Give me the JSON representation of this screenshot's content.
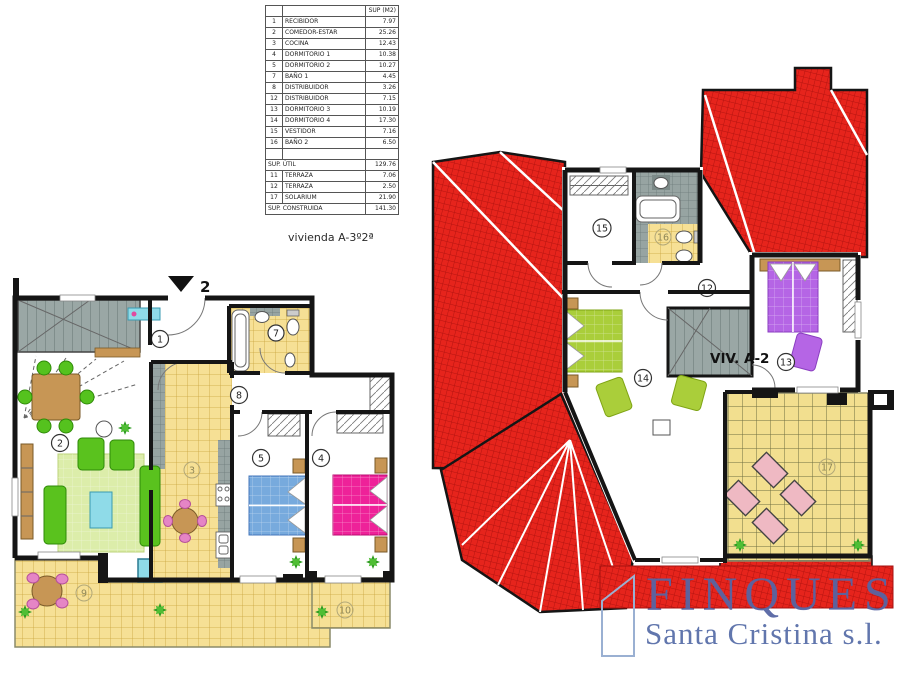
{
  "plan_caption": "vivienda A-3º2ª",
  "unit_label": "VIV. A-2",
  "entrance_number": "2",
  "area_table": {
    "value_header": "SUP (M2)",
    "rows": [
      {
        "num": "1",
        "name": "RECIBIDOR",
        "value": "7.97"
      },
      {
        "num": "2",
        "name": "COMEDOR-ESTAR",
        "value": "25.26"
      },
      {
        "num": "3",
        "name": "COCINA",
        "value": "12.43"
      },
      {
        "num": "4",
        "name": "DORMITORIO 1",
        "value": "10.38"
      },
      {
        "num": "5",
        "name": "DORMITORIO 2",
        "value": "10.27"
      },
      {
        "num": "7",
        "name": "BAÑO 1",
        "value": "4.45"
      },
      {
        "num": "8",
        "name": "DISTRIBUIDOR",
        "value": "3.26"
      },
      {
        "num": "12",
        "name": "DISTRIBUIDOR",
        "value": "7.15"
      },
      {
        "num": "13",
        "name": "DORMITORIO 3",
        "value": "10.19"
      },
      {
        "num": "14",
        "name": "DORMITORIO 4",
        "value": "17.30"
      },
      {
        "num": "15",
        "name": "VESTIDOR",
        "value": "7.16"
      },
      {
        "num": "16",
        "name": "BAÑO 2",
        "value": "6.50"
      },
      {
        "type": "blank"
      },
      {
        "type": "total",
        "name": "SUP. ÚTIL",
        "value": "129.76"
      },
      {
        "num": "11",
        "name": "TERRAZA",
        "value": "7.06"
      },
      {
        "num": "12",
        "name": "TERRAZA",
        "value": "2.50"
      },
      {
        "num": "17",
        "name": "SOLARIUM",
        "value": "21.90"
      },
      {
        "type": "total",
        "name": "SUP. CONSTRUIDA",
        "value": "141.30"
      }
    ]
  },
  "markers": {
    "recibidor": "1",
    "comedor": "2",
    "cocina": "3",
    "dorm1": "4",
    "dorm2": "5",
    "bano1": "7",
    "dist1": "8",
    "terraza1": "9",
    "terraza2": "10",
    "dist2": "12",
    "dorm3": "13",
    "dorm4": "14",
    "vestidor": "15",
    "bano2": "16",
    "solarium": "17"
  },
  "logo": {
    "name": "FINQUES",
    "subname": "Santa Cristina s.l."
  },
  "colors": {
    "roof_red": "#e8251d",
    "tile_yellow": "#f6e095",
    "logo_blue": "#5665a3"
  }
}
